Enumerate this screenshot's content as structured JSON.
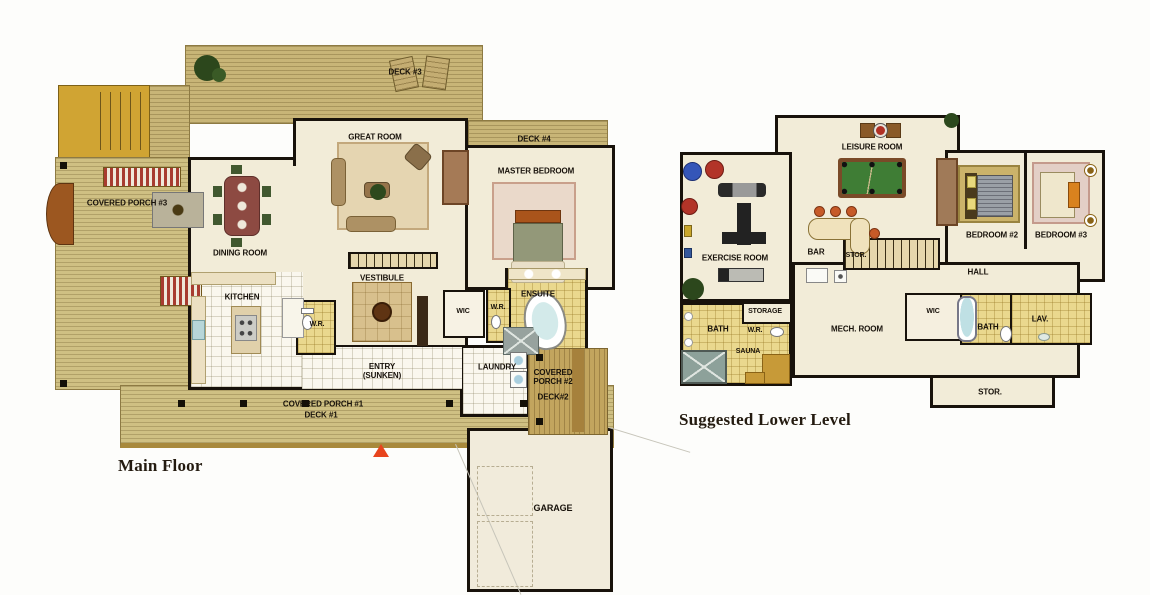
{
  "document": {
    "type": "architectural floor plan, two levels",
    "background": "#fdfdfb"
  },
  "colors": {
    "deck_wood": "#c8b577",
    "porch_wood": "#cfc083",
    "stair_gold": "#d0a433",
    "room_cream": "#f2ecd8",
    "wall_black": "#18120b",
    "tile_gold": "#ead88e",
    "pool_table_green": "#3f7d35",
    "marker_red": "#e8441d"
  },
  "main_floor": {
    "title": "Main Floor",
    "labels": {
      "deck3": "DECK #3",
      "great_room": "GREAT ROOM",
      "deck4": "DECK #4",
      "master_bedroom": "MASTER BEDROOM",
      "covered_porch3": "COVERED PORCH #3",
      "dining_room": "DINING ROOM",
      "kitchen": "KITCHEN",
      "vestibule": "VESTIBULE",
      "wr_left": "W.R.",
      "wic": "WIC",
      "wr_right": "W.R.",
      "ensuite": "ENSUITE",
      "entry": "ENTRY (SUNKEN)",
      "laundry": "LAUNDRY",
      "covered_porch2": "COVERED PORCH #2",
      "deck2": "DECK#2",
      "covered_porch1": "COVERED PORCH #1",
      "deck1": "DECK #1",
      "garage": "GARAGE"
    }
  },
  "lower_level": {
    "title": "Suggested Lower Level",
    "labels": {
      "leisure_room": "LEISURE ROOM",
      "exercise_room": "EXERCISE ROOM",
      "bar": "BAR",
      "stor_stairs": "STOR.",
      "bedroom2": "BEDROOM #2",
      "bedroom3": "BEDROOM #3",
      "hall": "HALL",
      "storage": "STORAGE",
      "bath_left": "BATH",
      "wr": "W.R.",
      "sauna": "SAUNA",
      "mech_room": "MECH. ROOM",
      "wic": "WIC",
      "bath_right": "BATH",
      "lav": "LAV.",
      "stor_bottom": "STOR."
    }
  }
}
